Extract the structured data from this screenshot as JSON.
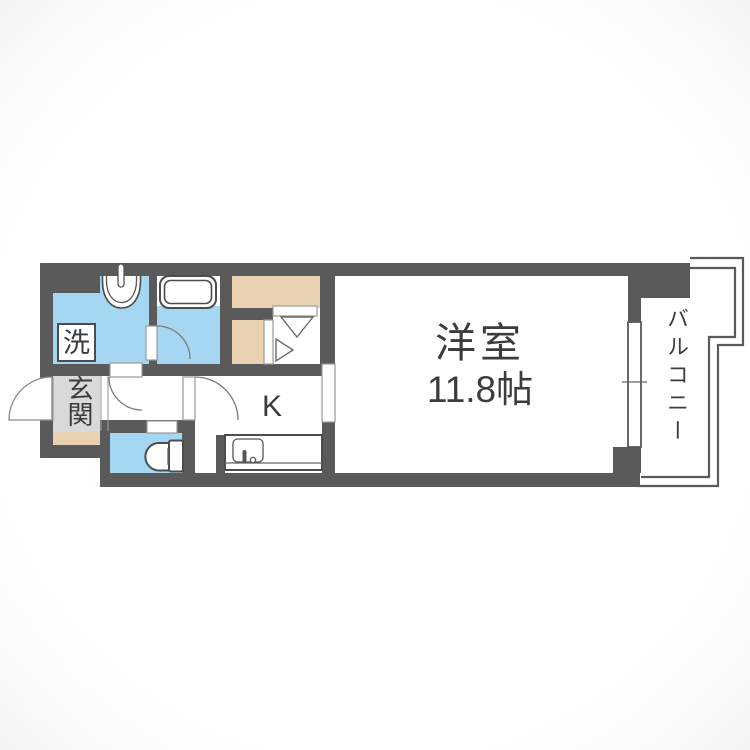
{
  "floorplan": {
    "type": "Japanese apartment floor plan (1K)",
    "labels": {
      "main_room_name": "洋室",
      "main_room_size": "11.8帖",
      "kitchen": "K",
      "balcony": "バルコニー",
      "entrance": "玄関",
      "laundry": "洗"
    },
    "colors": {
      "wall": "#5a5a5a",
      "wet_area": "#a6d7f2",
      "storage": "#e8d2b1",
      "entrance_floor": "#d9d9d9",
      "label_text": "#3c3c3c",
      "line": "#6b6b6b",
      "background": "#ffffff"
    }
  }
}
